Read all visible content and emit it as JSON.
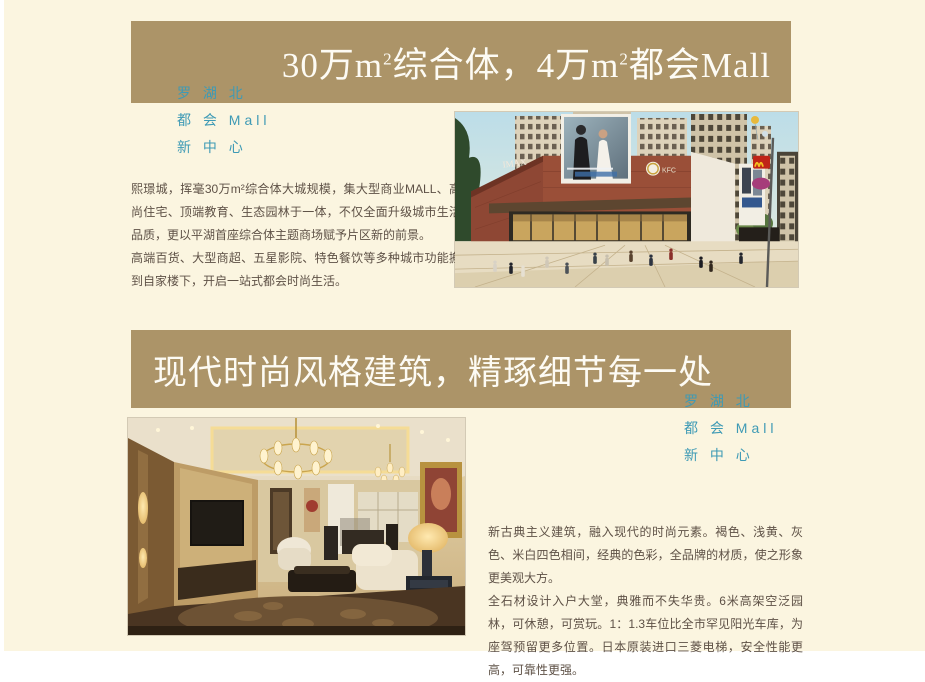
{
  "page": {
    "background_color": "#fbf5e0",
    "banner_color": "#ac9468",
    "accent_blue": "#3e9ab5",
    "body_text_color": "#5e5146"
  },
  "tagline": {
    "line1": "罗 湖 北",
    "line2": "都 会 Mall",
    "line3": "新 中 心"
  },
  "section_mall": {
    "banner_title_parts": {
      "p1": "30万m",
      "sup1": "2",
      "p2": "综合体，4万m",
      "sup2": "2",
      "p3": "都会Mall"
    },
    "paragraph1": "熙璟城，挥毫30万m²综合体大城规模，集大型商业MALL、高尚住宅、顶端教育、生态园林于一体，不仅全面升级城市生活品质，更以平湖首座综合体主题商场赋予片区新的前景。",
    "paragraph2": "高端百货、大型商超、五星影院、特色餐饮等多种城市功能搬到自家楼下，开启一站式都会时尚生活。",
    "image_signs": {
      "imax": "IMAX",
      "kfc": "KFC"
    }
  },
  "section_residence": {
    "banner_title": "现代时尚风格建筑，精琢细节每一处",
    "paragraph1": "新古典主义建筑，融入现代的时尚元素。褐色、浅黄、灰色、米白四色相间，经典的色彩，全品牌的材质，使之形象更美观大方。",
    "paragraph2": "全石材设计入户大堂，典雅而不失华贵。6米高架空泛园林，可休憩，可赏玩。1：1.3车位比全市罕见阳光车库，为座驾预留更多位置。日本原装进口三菱电梯，安全性能更高，可靠性更强。"
  }
}
